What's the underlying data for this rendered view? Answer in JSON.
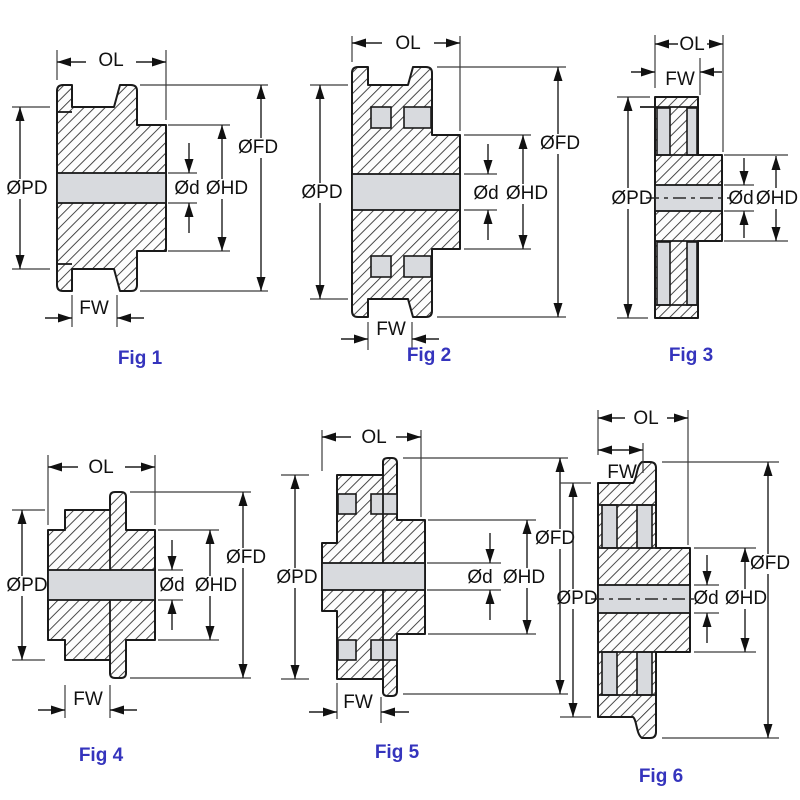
{
  "title": "Timing pulley dimension figures",
  "colors": {
    "background": "#ffffff",
    "line": "#1a1a1a",
    "shading": "#d8dade",
    "caption": "#3534bd"
  },
  "figures": [
    {
      "caption": "Fig 1",
      "labels": {
        "ol": "OL",
        "fw": "FW",
        "pd": "ØPD",
        "fd": "ØFD",
        "hd": "ØHD",
        "d": "Ød"
      }
    },
    {
      "caption": "Fig 2",
      "labels": {
        "ol": "OL",
        "fw": "FW",
        "pd": "ØPD",
        "fd": "ØFD",
        "hd": "ØHD",
        "d": "Ød"
      }
    },
    {
      "caption": "Fig 3",
      "labels": {
        "ol": "OL",
        "fw": "FW",
        "pd": "ØPD",
        "hd": "ØHD",
        "d": "Ød"
      }
    },
    {
      "caption": "Fig 4",
      "labels": {
        "ol": "OL",
        "fw": "FW",
        "pd": "ØPD",
        "fd": "ØFD",
        "hd": "ØHD",
        "d": "Ød"
      }
    },
    {
      "caption": "Fig 5",
      "labels": {
        "ol": "OL",
        "fw": "FW",
        "pd": "ØPD",
        "fd": "ØFD",
        "hd": "ØHD",
        "d": "Ød"
      }
    },
    {
      "caption": "Fig 6",
      "labels": {
        "ol": "OL",
        "fw": "FW",
        "pd": "ØPD",
        "fd": "ØFD",
        "hd": "ØHD",
        "d": "Ød"
      }
    }
  ]
}
